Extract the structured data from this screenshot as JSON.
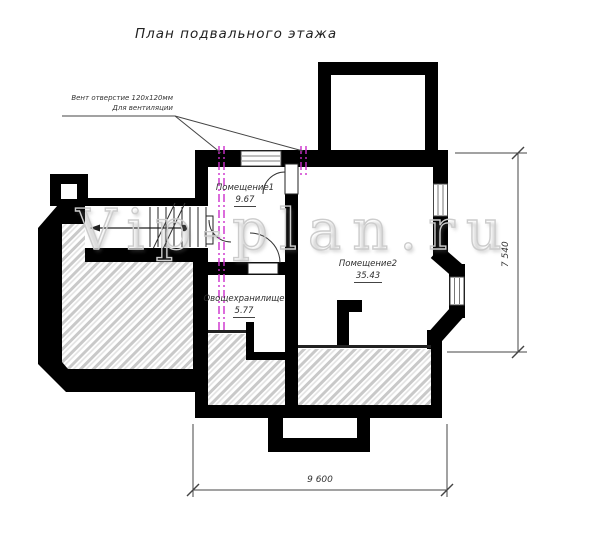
{
  "title": "План подвального этажа",
  "annotation": {
    "line1": "Вент отверстие 120х120мм",
    "line2": "Для вентиляции"
  },
  "watermark": "Vip-plan.ru",
  "rooms": [
    {
      "name": "Помещение1",
      "area": "9.67"
    },
    {
      "name": "Помещение2",
      "area": "35.43"
    },
    {
      "name": "Овощехранилище",
      "area": "5.77"
    }
  ],
  "dimensions": {
    "height_label": "7 540",
    "width_label": "9 600"
  },
  "colors": {
    "wall": "#000000",
    "vent_duct": "#cc2ecc",
    "hatch_line": "#c9c9c9",
    "drawing_line": "#333333",
    "watermark_outline": "#cccccc"
  }
}
